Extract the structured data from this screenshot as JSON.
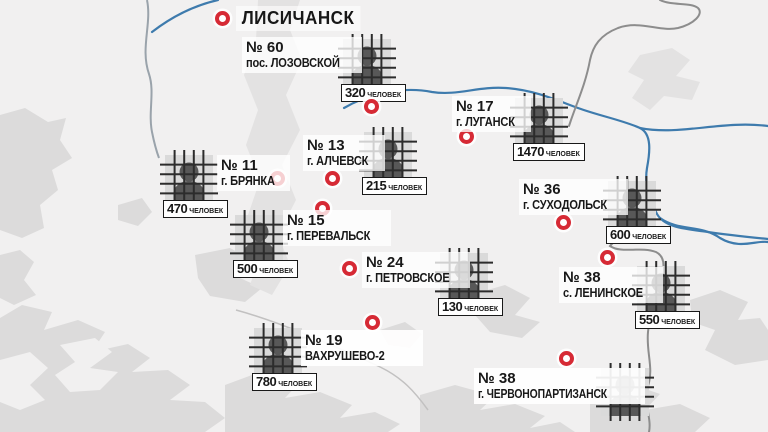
{
  "map": {
    "region_city": "ЛИСИЧАНСК",
    "unit_label": "ЧЕЛОВЕК",
    "colors": {
      "marker_red": "#d62a35",
      "river_blue": "#3e7bad",
      "border_gray": "#8d8d8d",
      "land": "#f1f0f0",
      "terrain_patch": "#dcdbdb",
      "icon_cell_bg": "#dadada",
      "icon_silhouette": "#585858",
      "icon_bars": "#2c2c2c"
    },
    "icons": {
      "marker": "location-marker",
      "facility": "prisoner-behind-bars-icon"
    },
    "facilities": [
      {
        "number": "№ 60",
        "place": "пос. ЛОЗОВСКОЙ",
        "count": "320"
      },
      {
        "number": "№ 17",
        "place": "г. ЛУГАНСК",
        "count": "1470"
      },
      {
        "number": "№ 13",
        "place": "г. АЛЧЕВСК",
        "count": "215"
      },
      {
        "number": "№ 11",
        "place": "г. БРЯНКА",
        "count": "470"
      },
      {
        "number": "№ 15",
        "place": "г. ПЕРЕВАЛЬСК",
        "count": "500"
      },
      {
        "number": "№ 36",
        "place": "г. СУХОДОЛЬСК",
        "count": "600"
      },
      {
        "number": "№ 24",
        "place": "г. ПЕТРОВСКОЕ",
        "count": "130"
      },
      {
        "number": "№ 38",
        "place": "с. ЛЕНИНСКОЕ",
        "count": "550"
      },
      {
        "number": "№ 19",
        "place": "ВАХРУШЕВО-2",
        "count": "780"
      },
      {
        "number": "№ 38",
        "place": "г. ЧЕРВОНОПАРТИЗАНСК",
        "count": ""
      }
    ]
  }
}
